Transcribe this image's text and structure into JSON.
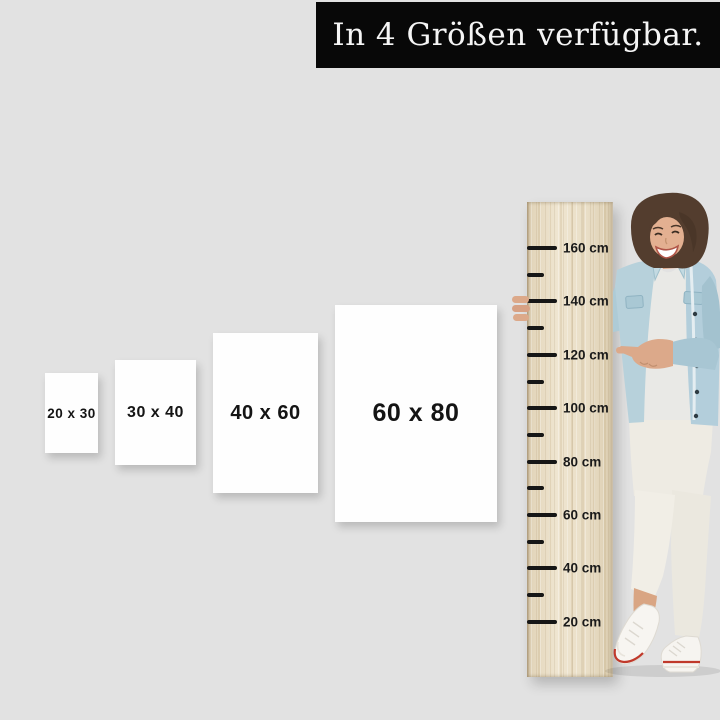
{
  "background_color": "#e2e2e2",
  "banner": {
    "text": "In 4 Größen verfügbar.",
    "bg_color": "#080808",
    "text_color": "#f5f5f5"
  },
  "size_options": [
    {
      "label": "20 x 30"
    },
    {
      "label": "30 x 40"
    },
    {
      "label": "40 x 60"
    },
    {
      "label": "60 x 80"
    }
  ],
  "ruler": {
    "unit": "cm",
    "major_labels": [
      "160 cm",
      "140 cm",
      "120 cm",
      "100 cm",
      "80 cm",
      "60 cm",
      "40 cm",
      "20 cm"
    ],
    "wood_color": "#e9dec6",
    "tick_color": "#161616",
    "label_color": "#1a1a1a"
  },
  "accent_colors": {
    "shoe_stripe_red": "#c0392b",
    "denim_jacket_blue": "#b7d1db",
    "skin_tone": "#dca98a",
    "hair_brown": "#533d2e"
  }
}
